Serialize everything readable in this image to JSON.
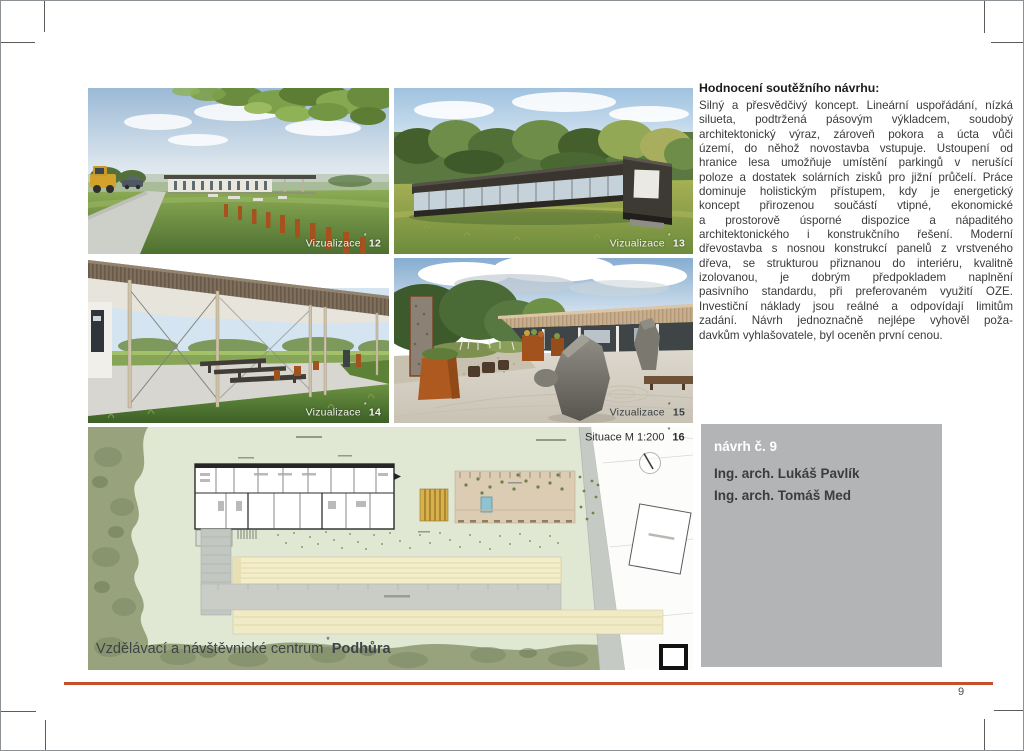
{
  "page": {
    "number": "9"
  },
  "star": "*",
  "evaluation": {
    "heading": "Hodnocení soutěžního návrhu:",
    "lines": [
      "Silný a přesvědčivý koncept. Lineární uspořádání, nízká",
      "silueta, podtržená pásovým výkladcem, soudobý",
      "architektonický výraz, zároveň pokora a úcta vůči",
      "území, do něhož novostavba vstupuje. Ustoupení od",
      "hranice lesa umožňuje umístění parkingů v nerušící",
      "poloze a dostatek solárních zisků pro jižní průčelí. Práce",
      "dominuje holistickým přístupem, kdy je energetický",
      "koncept přirozenou součástí vtipné, ekonomické",
      "a prostorově úsporné dispozice a nápaditého",
      "architektonického i konstrukčního řešení. Moderní",
      "dřevostavba s nosnou konstrukcí panelů z vrstveného",
      "dřeva, se strukturou přiznanou do interiéru, kvalitně",
      "izolovanou, je dobrým předpokladem naplnění",
      "pasivního standardu, při preferovaném využití OZE.",
      "Investiční náklady jsou reálné a odpovídají limitům",
      "zadání. Návrh jednoznačně nejlépe vyhověl poža-",
      "davkům vyhlašovatele, byl oceněn první cenou."
    ]
  },
  "figures": {
    "f12": {
      "label": "Vizualizace",
      "num": "12"
    },
    "f13": {
      "label": "Vizualizace",
      "num": "13"
    },
    "f14": {
      "label": "Vizualizace",
      "num": "14"
    },
    "f15": {
      "label": "Vizualizace",
      "num": "15"
    },
    "f16": {
      "label": "Situace M 1:200",
      "num": "16"
    }
  },
  "plan": {
    "caption": "Vzdělávací a návštěvnické centrum",
    "caption_bold": "Podhůra"
  },
  "entry": {
    "title": "návrh č. 9",
    "authors": [
      "Ing. arch. Lukáš Pavlík",
      "Ing. arch. Tomáš Med"
    ]
  },
  "colors": {
    "accent_rule": "#c7502a",
    "entry_panel": "#b2b4b5"
  }
}
